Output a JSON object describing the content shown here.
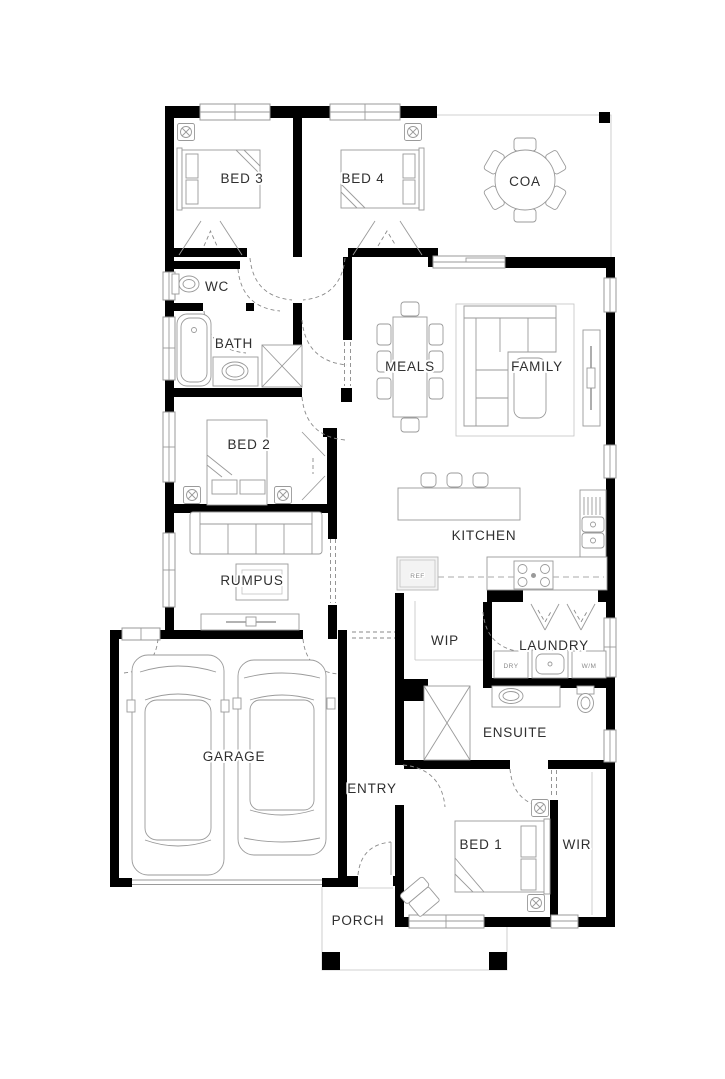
{
  "rooms": {
    "bed3": "BED 3",
    "bed4": "BED 4",
    "coa": "COA",
    "wc": "WC",
    "bath": "BATH",
    "meals": "MEALS",
    "family": "FAMILY",
    "bed2": "BED 2",
    "kitchen": "KITCHEN",
    "rumpus": "RUMPUS",
    "wip": "WIP",
    "laundry": "LAUNDRY",
    "ensuite": "ENSUITE",
    "garage": "GARAGE",
    "entry": "ENTRY",
    "bed1": "BED 1",
    "wir": "WIR",
    "porch": "PORCH"
  },
  "labels": {
    "ref": "REF",
    "dry": "DRY",
    "wm": "W/M"
  },
  "colors": {
    "wall": "#000000",
    "furniture_line": "#9a9a9a",
    "background": "#ffffff",
    "text": "#2f2f2f"
  }
}
